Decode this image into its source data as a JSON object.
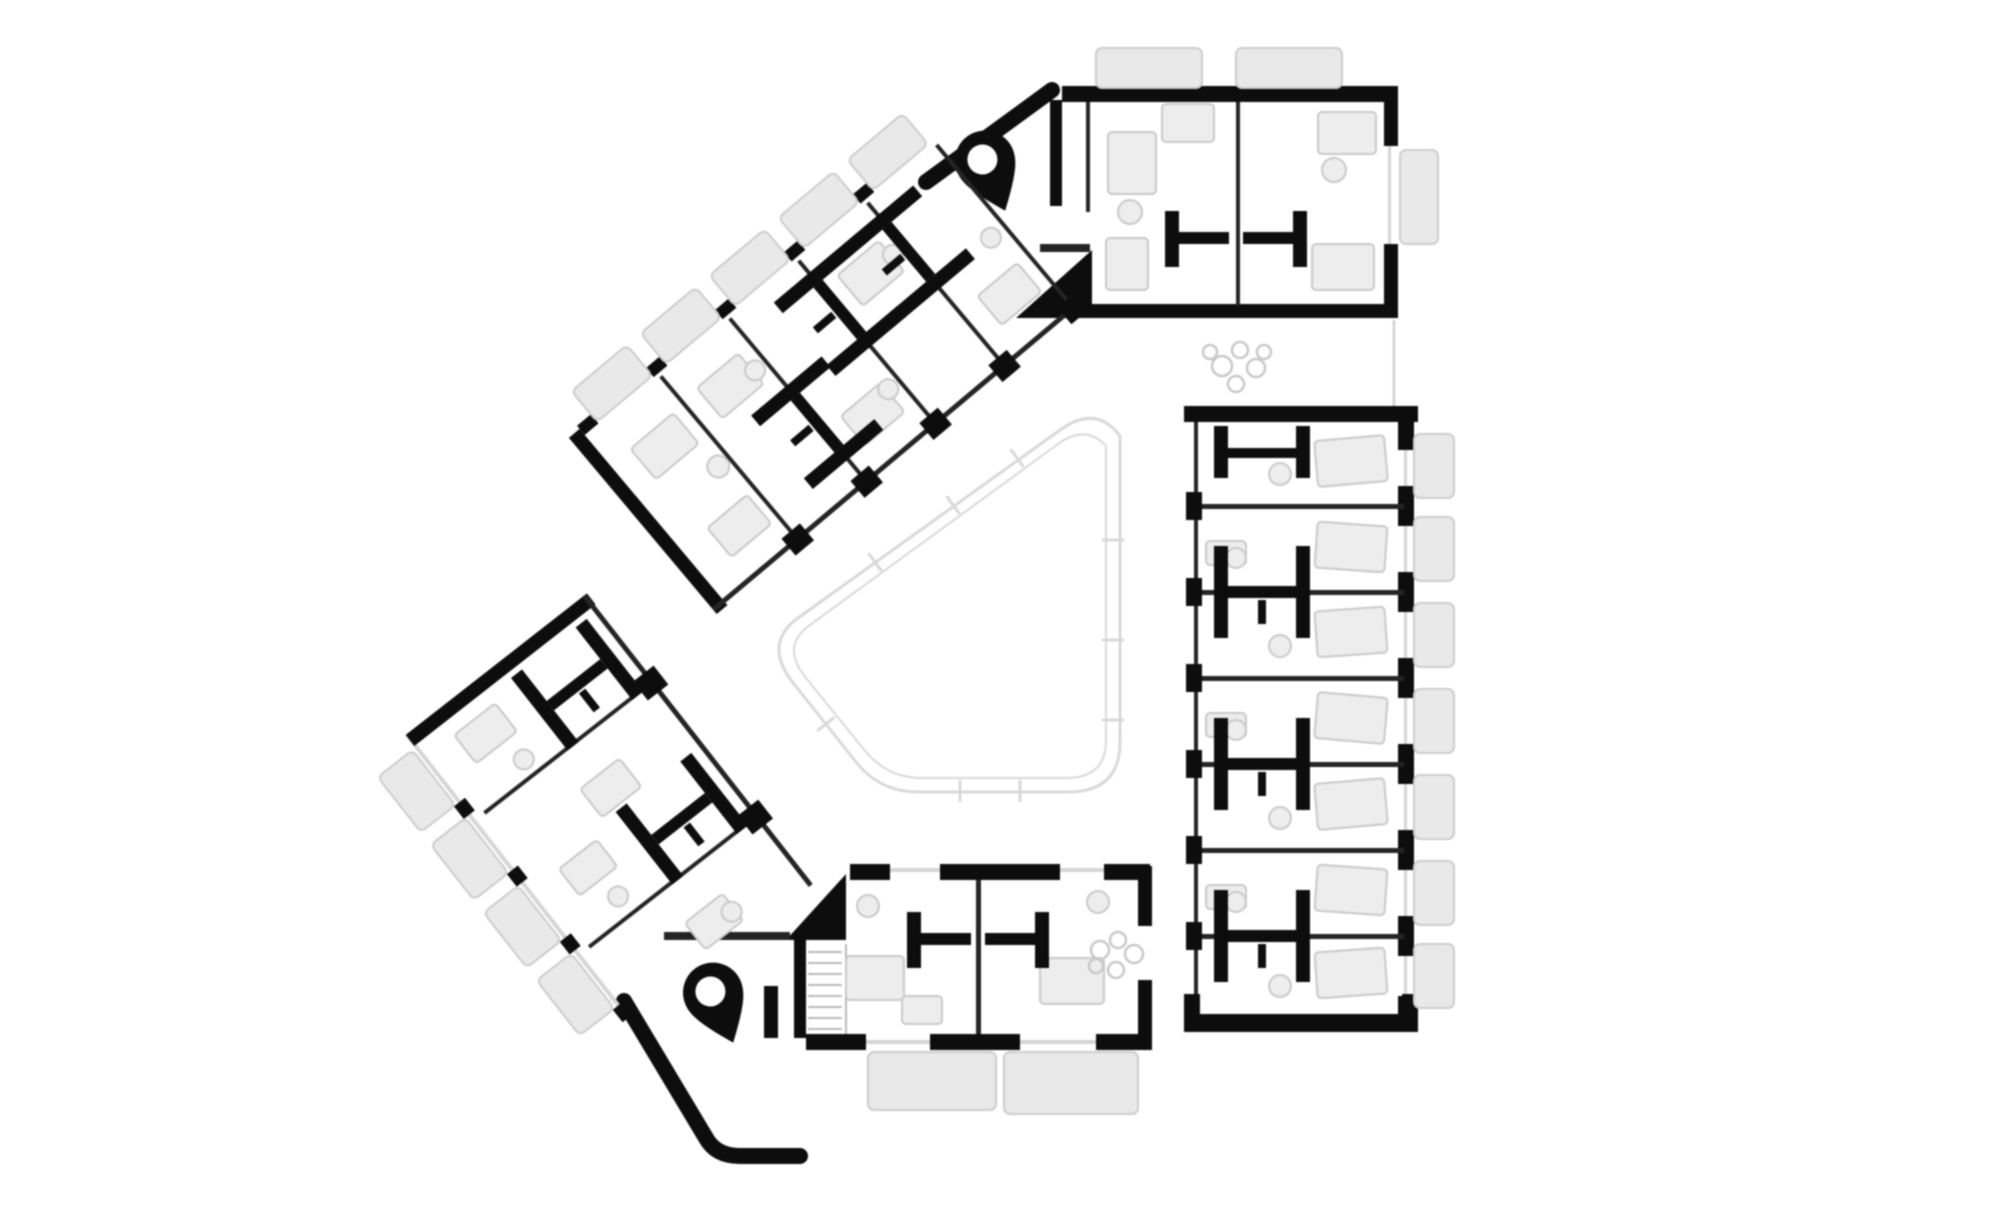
{
  "meta": {
    "title": "Upper floor plan — triangular residential block around a central courtyard",
    "drawing_type": "architectural-floor-plan",
    "visible_text": "none"
  },
  "palette": {
    "bg": "#ffffff",
    "wall": "#0d0d0d",
    "partition": "#242424",
    "line-light": "#d6d6d6",
    "line-mid": "#b9b9b9",
    "fill-window": "#e9e9e9",
    "stroke-window": "#cdcdcd",
    "fill-furniture": "#ededed",
    "stroke-furniture": "#c9c9c9",
    "courtyard": "#d9d9d9"
  },
  "inventory": {
    "wings": [
      "northwest-wing",
      "southwest-wing",
      "east-wing"
    ],
    "corner_units": [
      "northeast-unit",
      "south-unit"
    ],
    "stair_cores": 2,
    "bathroom_pods": 11,
    "window_bays": 16,
    "balconies": 2,
    "plant_clusters": 2,
    "stair_flights": 1
  },
  "stamps": {
    "windows": [
      {
        "p": "nw",
        "x": 32,
        "y": -42,
        "w": 72,
        "h": 40
      },
      {
        "p": "nw",
        "x": 122,
        "y": -42,
        "w": 72,
        "h": 40
      },
      {
        "p": "nw",
        "x": 212,
        "y": -42,
        "w": 72,
        "h": 40
      },
      {
        "p": "nw",
        "x": 302,
        "y": -42,
        "w": 72,
        "h": 40
      },
      {
        "p": "nw",
        "x": 392,
        "y": -42,
        "w": 72,
        "h": 40
      },
      {
        "p": "sw",
        "x": -56,
        "y": 16,
        "w": 44,
        "h": 70
      },
      {
        "p": "sw",
        "x": -56,
        "y": 102,
        "w": 44,
        "h": 70
      },
      {
        "p": "sw",
        "x": -56,
        "y": 188,
        "w": 44,
        "h": 70
      },
      {
        "p": "sw",
        "x": -56,
        "y": 274,
        "w": 44,
        "h": 70
      },
      {
        "p": "rt",
        "x": 1414,
        "y": 434,
        "w": 40,
        "h": 64
      },
      {
        "p": "rt",
        "x": 1414,
        "y": 517,
        "w": 40,
        "h": 64
      },
      {
        "p": "rt",
        "x": 1414,
        "y": 603,
        "w": 40,
        "h": 64
      },
      {
        "p": "rt",
        "x": 1414,
        "y": 689,
        "w": 40,
        "h": 64
      },
      {
        "p": "rt",
        "x": 1414,
        "y": 775,
        "w": 40,
        "h": 64
      },
      {
        "p": "rt",
        "x": 1414,
        "y": 861,
        "w": 40,
        "h": 64
      },
      {
        "p": "rt",
        "x": 1414,
        "y": 944,
        "w": 40,
        "h": 64
      },
      {
        "p": "rt",
        "x": 1096,
        "y": 48,
        "w": 106,
        "h": 40
      },
      {
        "p": "rt",
        "x": 1236,
        "y": 48,
        "w": 106,
        "h": 40
      },
      {
        "p": "rt",
        "x": 1400,
        "y": 150,
        "w": 38,
        "h": 94
      },
      {
        "p": "rt",
        "x": 868,
        "y": 1052,
        "w": 128,
        "h": 58
      },
      {
        "p": "rt",
        "x": 1004,
        "y": 1052,
        "w": 134,
        "h": 62
      }
    ],
    "pods": [
      {
        "p": "rt",
        "x": 1262,
        "y": 452,
        "k": "half",
        "a": 0
      },
      {
        "p": "rt",
        "x": 1262,
        "y": 592,
        "k": "tall",
        "a": 0
      },
      {
        "p": "rt",
        "x": 1262,
        "y": 764,
        "k": "tall",
        "a": 0
      },
      {
        "p": "rt",
        "x": 1262,
        "y": 936,
        "k": "tall",
        "a": 0
      },
      {
        "p": "rt",
        "x": 1236,
        "y": 239,
        "k": "wide",
        "a": 0
      },
      {
        "p": "rt",
        "x": 978,
        "y": 940,
        "k": "wide",
        "a": 0
      },
      {
        "p": "nw",
        "x": 200,
        "y": 140,
        "k": "tall",
        "a": 90
      },
      {
        "p": "nw",
        "x": 290,
        "y": 68,
        "k": "tall",
        "a": 90
      },
      {
        "p": "nw",
        "x": 380,
        "y": 68,
        "k": "tall",
        "a": 90
      },
      {
        "p": "sw",
        "x": 158,
        "y": 66,
        "k": "tall",
        "a": 0
      },
      {
        "p": "sw",
        "x": 158,
        "y": 236,
        "k": "tall",
        "a": 0
      }
    ],
    "pins": [
      {
        "p": "rt",
        "x": 988,
        "y": 168,
        "a": -22
      },
      {
        "p": "rt",
        "x": 716,
        "y": 1000,
        "a": -22
      }
    ],
    "furn_rects": [
      {
        "p": "rt",
        "x": 1108,
        "y": 132,
        "w": 48,
        "h": 62,
        "a": 0
      },
      {
        "p": "rt",
        "x": 1162,
        "y": 104,
        "w": 52,
        "h": 38,
        "a": 0
      },
      {
        "p": "rt",
        "x": 1106,
        "y": 238,
        "w": 42,
        "h": 52,
        "a": 0
      },
      {
        "p": "rt",
        "x": 1318,
        "y": 112,
        "w": 58,
        "h": 42,
        "a": 0
      },
      {
        "p": "rt",
        "x": 1312,
        "y": 244,
        "w": 62,
        "h": 46,
        "a": 0
      },
      {
        "p": "rt",
        "x": 1316,
        "y": 438,
        "w": 70,
        "h": 46,
        "a": -5
      },
      {
        "p": "rt",
        "x": 1206,
        "y": 541,
        "w": 40,
        "h": 24,
        "a": 0
      },
      {
        "p": "rt",
        "x": 1316,
        "y": 524,
        "w": 70,
        "h": 46,
        "a": 4
      },
      {
        "p": "rt",
        "x": 1316,
        "y": 609,
        "w": 70,
        "h": 46,
        "a": -4
      },
      {
        "p": "rt",
        "x": 1206,
        "y": 713,
        "w": 40,
        "h": 24,
        "a": 0
      },
      {
        "p": "rt",
        "x": 1316,
        "y": 695,
        "w": 70,
        "h": 46,
        "a": 5
      },
      {
        "p": "rt",
        "x": 1316,
        "y": 781,
        "w": 70,
        "h": 46,
        "a": -5
      },
      {
        "p": "rt",
        "x": 1316,
        "y": 867,
        "w": 70,
        "h": 46,
        "a": 4
      },
      {
        "p": "rt",
        "x": 1206,
        "y": 885,
        "w": 40,
        "h": 24,
        "a": 0
      },
      {
        "p": "rt",
        "x": 1316,
        "y": 950,
        "w": 70,
        "h": 46,
        "a": -4
      },
      {
        "p": "rt",
        "x": 846,
        "y": 956,
        "w": 58,
        "h": 44,
        "a": 0
      },
      {
        "p": "rt",
        "x": 1040,
        "y": 958,
        "w": 64,
        "h": 46,
        "a": 0
      },
      {
        "p": "rt",
        "x": 902,
        "y": 996,
        "w": 40,
        "h": 28,
        "a": 0
      },
      {
        "p": "nw",
        "x": 40,
        "y": 40,
        "w": 56,
        "h": 40,
        "a": 0
      },
      {
        "p": "nw",
        "x": 48,
        "y": 150,
        "w": 52,
        "h": 38,
        "a": 0
      },
      {
        "p": "nw",
        "x": 130,
        "y": 36,
        "w": 54,
        "h": 40,
        "a": 0
      },
      {
        "p": "nw",
        "x": 222,
        "y": 150,
        "w": 52,
        "h": 38,
        "a": 0
      },
      {
        "p": "nw",
        "x": 310,
        "y": 40,
        "w": 54,
        "h": 40,
        "a": 0
      },
      {
        "p": "nw",
        "x": 404,
        "y": 146,
        "w": 52,
        "h": 38,
        "a": 0
      },
      {
        "p": "sw",
        "x": 30,
        "y": 30,
        "w": 52,
        "h": 36,
        "a": 0
      },
      {
        "p": "sw",
        "x": 96,
        "y": 150,
        "w": 50,
        "h": 36,
        "a": 0
      },
      {
        "p": "sw",
        "x": 30,
        "y": 200,
        "w": 48,
        "h": 34,
        "a": 0
      },
      {
        "p": "sw",
        "x": 96,
        "y": 320,
        "w": 48,
        "h": 34,
        "a": 0
      }
    ],
    "furn_circles": [
      {
        "p": "rt",
        "x": 1130,
        "y": 212,
        "r": 12
      },
      {
        "p": "rt",
        "x": 1334,
        "y": 170,
        "r": 12
      },
      {
        "p": "rt",
        "x": 1280,
        "y": 474,
        "r": 11
      },
      {
        "p": "rt",
        "x": 1236,
        "y": 558,
        "r": 10
      },
      {
        "p": "rt",
        "x": 1280,
        "y": 646,
        "r": 11
      },
      {
        "p": "rt",
        "x": 1236,
        "y": 730,
        "r": 10
      },
      {
        "p": "rt",
        "x": 1280,
        "y": 818,
        "r": 11
      },
      {
        "p": "rt",
        "x": 1236,
        "y": 902,
        "r": 10
      },
      {
        "p": "rt",
        "x": 1280,
        "y": 986,
        "r": 11
      },
      {
        "p": "rt",
        "x": 868,
        "y": 906,
        "r": 11
      },
      {
        "p": "rt",
        "x": 1098,
        "y": 902,
        "r": 11
      },
      {
        "p": "nw",
        "x": 96,
        "y": 110,
        "r": 11
      },
      {
        "p": "nw",
        "x": 186,
        "y": 60,
        "r": 10
      },
      {
        "p": "nw",
        "x": 276,
        "y": 160,
        "r": 10
      },
      {
        "p": "nw",
        "x": 366,
        "y": 60,
        "r": 10
      },
      {
        "p": "nw",
        "x": 452,
        "y": 110,
        "r": 10
      },
      {
        "p": "sw",
        "x": 70,
        "y": 92,
        "r": 10
      },
      {
        "p": "sw",
        "x": 60,
        "y": 258,
        "r": 10
      },
      {
        "p": "sw",
        "x": 140,
        "y": 340,
        "r": 10
      }
    ],
    "plants": [
      {
        "p": "rt",
        "x": 1222,
        "y": 366,
        "r": 10
      },
      {
        "p": "rt",
        "x": 1240,
        "y": 350,
        "r": 8
      },
      {
        "p": "rt",
        "x": 1256,
        "y": 368,
        "r": 9
      },
      {
        "p": "rt",
        "x": 1236,
        "y": 384,
        "r": 8
      },
      {
        "p": "rt",
        "x": 1264,
        "y": 352,
        "r": 7
      },
      {
        "p": "rt",
        "x": 1210,
        "y": 352,
        "r": 7
      },
      {
        "p": "rt",
        "x": 1100,
        "y": 950,
        "r": 9
      },
      {
        "p": "rt",
        "x": 1118,
        "y": 940,
        "r": 8
      },
      {
        "p": "rt",
        "x": 1134,
        "y": 954,
        "r": 9
      },
      {
        "p": "rt",
        "x": 1116,
        "y": 970,
        "r": 8
      },
      {
        "p": "rt",
        "x": 1096,
        "y": 966,
        "r": 7
      }
    ],
    "ticks": [
      {
        "x": 875,
        "y": 562,
        "a": 54
      },
      {
        "x": 953,
        "y": 505,
        "a": 54
      },
      {
        "x": 1017,
        "y": 458,
        "a": 54
      },
      {
        "x": 1113,
        "y": 540,
        "a": 0
      },
      {
        "x": 1113,
        "y": 640,
        "a": 0
      },
      {
        "x": 1113,
        "y": 720,
        "a": 0
      },
      {
        "x": 960,
        "y": 791,
        "a": 90
      },
      {
        "x": 1020,
        "y": 791,
        "a": 90
      },
      {
        "x": 826,
        "y": 724,
        "a": -38
      }
    ],
    "treads": [
      {
        "x1": 808,
        "y1": 952,
        "x2": 842,
        "y2": 952
      },
      {
        "x1": 808,
        "y1": 963,
        "x2": 842,
        "y2": 963
      },
      {
        "x1": 808,
        "y1": 974,
        "x2": 842,
        "y2": 974
      },
      {
        "x1": 808,
        "y1": 985,
        "x2": 842,
        "y2": 985
      },
      {
        "x1": 808,
        "y1": 996,
        "x2": 842,
        "y2": 996
      },
      {
        "x1": 808,
        "y1": 1007,
        "x2": 842,
        "y2": 1007
      },
      {
        "x1": 808,
        "y1": 1018,
        "x2": 842,
        "y2": 1018
      },
      {
        "x1": 808,
        "y1": 1029,
        "x2": 842,
        "y2": 1029
      }
    ]
  }
}
